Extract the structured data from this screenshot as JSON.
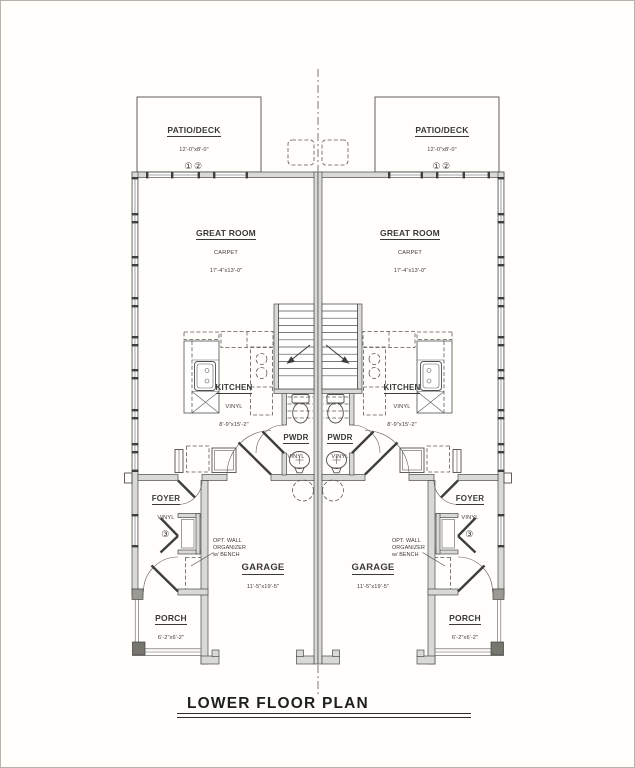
{
  "drawing_title": "LOWER FLOOR PLAN",
  "rooms": {
    "patio_deck": {
      "name": "PATIO/DECK",
      "dim": "12'-0\"x8'-0\"",
      "keys": "①②"
    },
    "great_room": {
      "name": "GREAT ROOM",
      "floor": "CARPET",
      "dim": "17'-4\"x13'-0\""
    },
    "kitchen": {
      "name": "KITCHEN",
      "floor": "VINYL",
      "dim": "8'-9\"x15'-2\""
    },
    "pwdr": {
      "name": "PWDR",
      "floor": "VINYL"
    },
    "foyer": {
      "name": "FOYER",
      "floor": "VINYL",
      "key": "③"
    },
    "garage": {
      "name": "GARAGE",
      "dim": "11'-5\"x19'-5\""
    },
    "porch": {
      "name": "PORCH",
      "dim": "6'-2\"x6'-2\""
    }
  },
  "annotations": {
    "opt_wall_organizer": [
      "OPT. WALL",
      "ORGANIZER",
      "w/ BENCH"
    ]
  },
  "colors": {
    "line": "#4f4f4f",
    "wall_fill": "#d9d9d5",
    "text": "#3a3a3a",
    "background": "#fffefb"
  }
}
